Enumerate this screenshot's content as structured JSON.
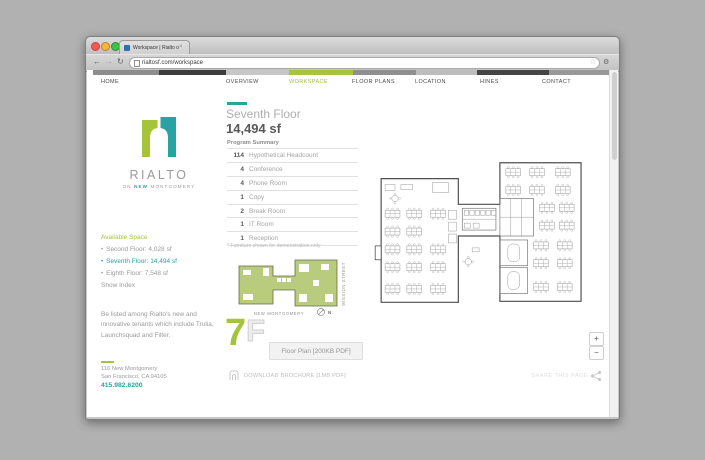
{
  "browser": {
    "tab_title": "Workspace | Rialto on New…",
    "url": "rialtosf.com/workspace",
    "chrome": {
      "back": "←",
      "forward": "→",
      "reload": "↻",
      "star": "☆",
      "menu": "⚙",
      "tab_close": "×"
    }
  },
  "nav": {
    "items": [
      {
        "label": "HOME",
        "active": false
      },
      {
        "label": "OVERVIEW",
        "active": false
      },
      {
        "label": "WORKSPACE",
        "active": true
      },
      {
        "label": "FLOOR PLANS",
        "active": false
      },
      {
        "label": "LOCATION",
        "active": false
      },
      {
        "label": "HINES",
        "active": false
      },
      {
        "label": "CONTACT",
        "active": false
      }
    ]
  },
  "logo": {
    "brand": "RIALTO",
    "tagline_pre": "ON",
    "tagline_accent": "NEW",
    "tagline_post": "MONTGOMERY"
  },
  "sidebar": {
    "available_space_title": "Available Space",
    "floors": [
      {
        "bullet": "•",
        "label": "Second Floor: 4,028 sf",
        "active": false
      },
      {
        "bullet": "•",
        "label": "Seventh Floor: 14,494 sf",
        "active": true
      },
      {
        "bullet": "•",
        "label": "Eighth Floor: 7,548 sf",
        "active": false
      }
    ],
    "show_index": "Show Index",
    "blurb": "Be listed among Rialto's new and innovative tenants which include Trulia, Launchsquad and Filter.",
    "address_line1": "116 New Montgomery",
    "address_line2": "San Francisco, CA 94105",
    "phone": "415.982.6200"
  },
  "main": {
    "floor_title": "Seventh Floor",
    "floor_size": "14,494 sf",
    "program_summary_title": "Program Summary",
    "program": [
      {
        "qty": "114",
        "label": "Hypothetical Headcount"
      },
      {
        "qty": "4",
        "label": "Conference"
      },
      {
        "qty": "4",
        "label": "Phone Room"
      },
      {
        "qty": "1",
        "label": "Copy"
      },
      {
        "qty": "2",
        "label": "Break Room"
      },
      {
        "qty": "1",
        "label": "IT Room"
      },
      {
        "qty": "1",
        "label": "Reception"
      }
    ],
    "footnote": "* Furniture shown for demonstration only",
    "keyplan": {
      "street_bottom": "NEW MONTGOMERY",
      "street_right": "MISSION STREET",
      "compass": "N"
    },
    "badge": {
      "number": "7",
      "letter": "F"
    },
    "floor_plan_button": "Floor Plan [200KB PDF]",
    "download_brochure": "DOWNLOAD BROCHURE [1MB PDF]"
  },
  "viewer": {
    "zoom_in": "+",
    "zoom_out": "−",
    "share_label": "SHARE THIS PAGE"
  },
  "colors": {
    "green": "#a6c33c",
    "teal": "#29a3a1",
    "keyplan_fill": "#b9cb7d"
  }
}
